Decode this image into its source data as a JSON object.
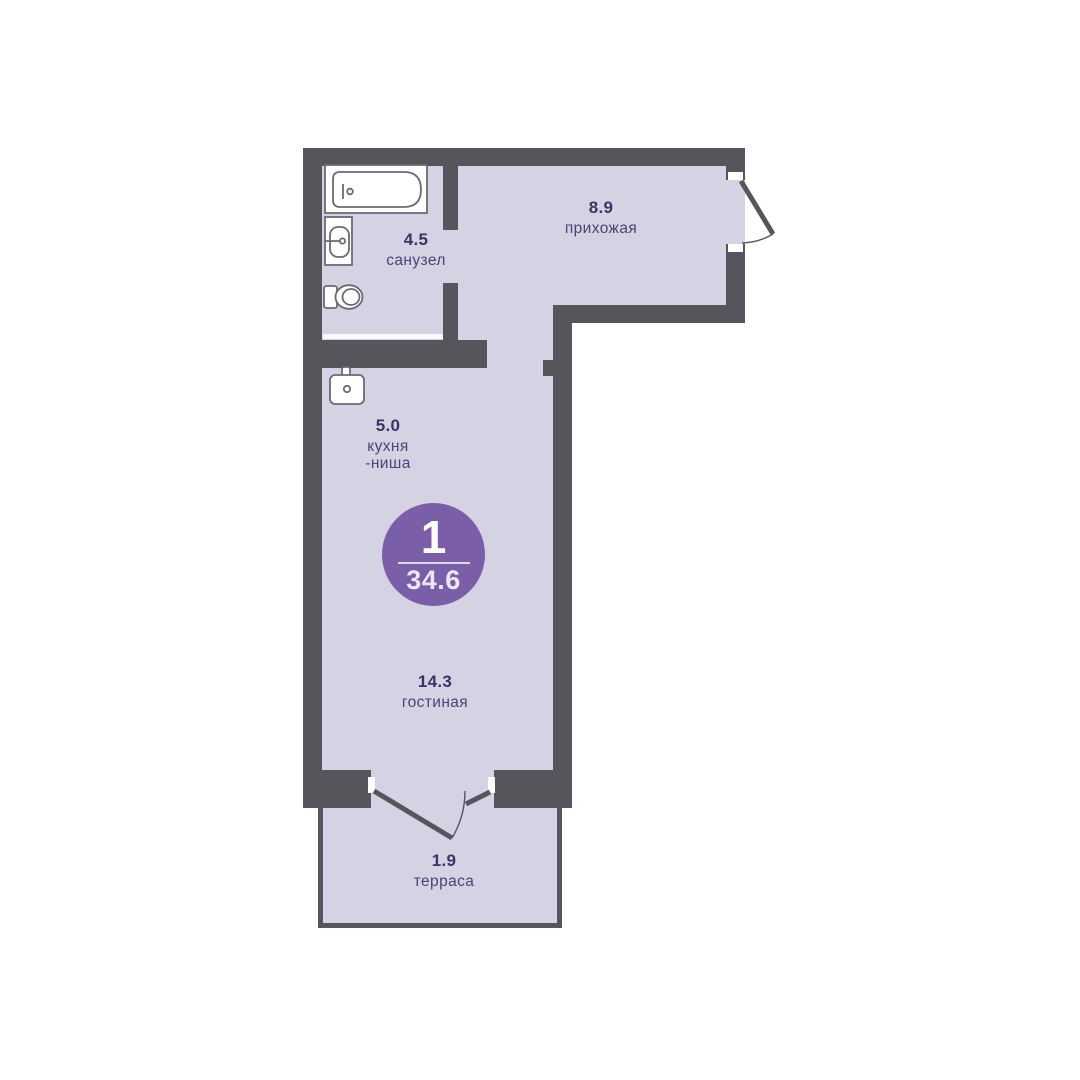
{
  "plan": {
    "unit_badge": {
      "rooms_count": "1",
      "total_area": "34.6"
    },
    "rooms": [
      {
        "id": "sanuzel",
        "area": "4.5",
        "name": "санузел"
      },
      {
        "id": "prihozhaya",
        "area": "8.9",
        "name": "прихожая"
      },
      {
        "id": "kuhnya_nisha",
        "area": "5.0",
        "name": "кухня",
        "name_line2": "-ниша"
      },
      {
        "id": "gostinaya",
        "area": "14.3",
        "name": "гостиная"
      },
      {
        "id": "terrasa",
        "area": "1.9",
        "name": "терраса"
      }
    ],
    "fixtures": [
      "bathtub",
      "sink",
      "toilet",
      "kitchen-sink"
    ],
    "colors": {
      "wall": "#57555b",
      "floor": "#d5d3e3",
      "badge": "#7a5fa8",
      "text_number": "#3e3165",
      "text_name": "#4d4178",
      "fixture_stroke": "#6b6973"
    }
  }
}
